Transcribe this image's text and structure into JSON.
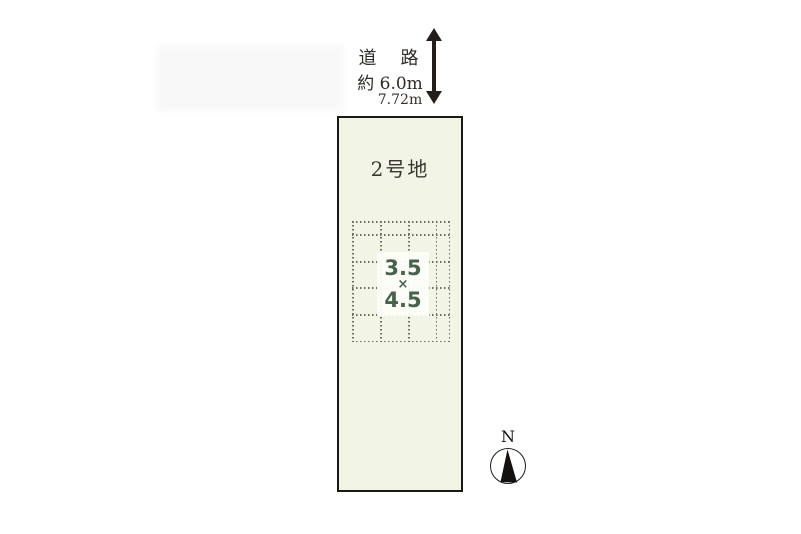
{
  "diagram": {
    "road": {
      "label": "道　路",
      "width_label": "約 6.0m"
    },
    "frontage_label": "7.72m",
    "lot": {
      "name": "2号地"
    },
    "building_dims": {
      "width": "3.5",
      "multiply_sign": "×",
      "depth": "4.5"
    },
    "compass": {
      "north_label": "N"
    }
  },
  "colors": {
    "lot_fill": "#f2f5e6",
    "lot_border": "#1b1712",
    "grid_dots": "#6c6c5e",
    "dims_text": "#47614b",
    "label_text": "#2f2b27",
    "arrow": "#231e19"
  }
}
